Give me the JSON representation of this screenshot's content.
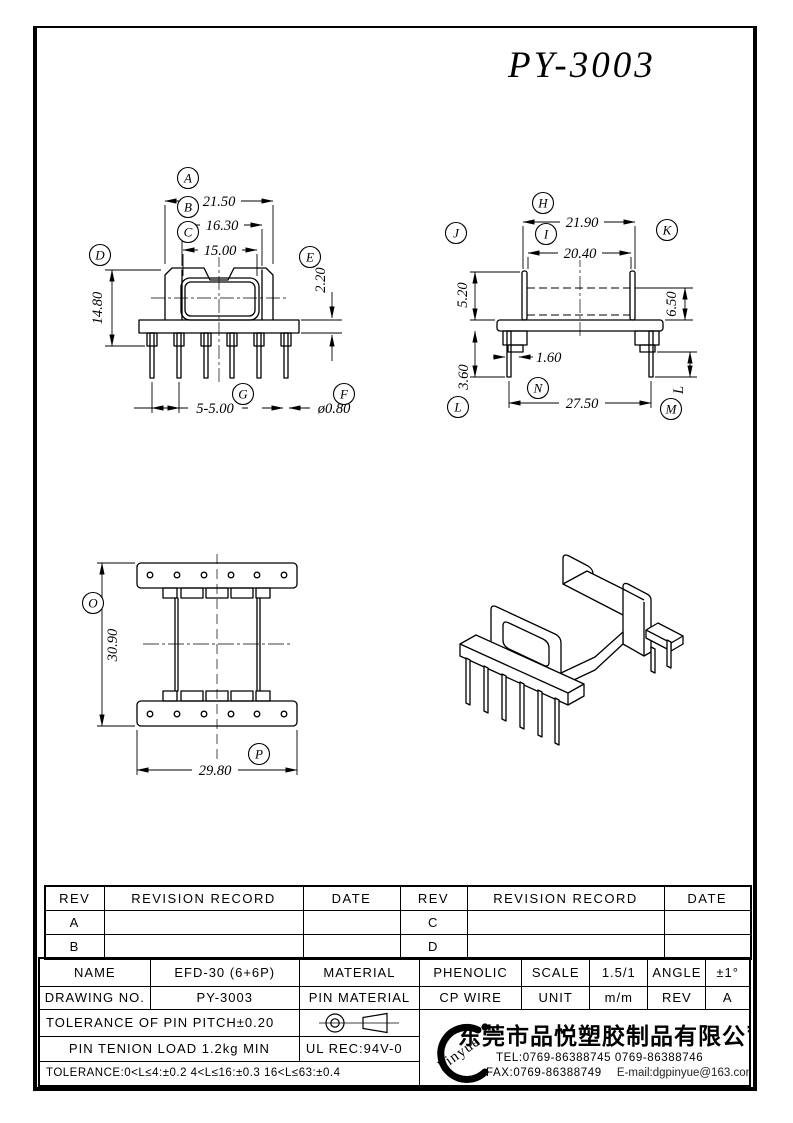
{
  "page": {
    "title": "PY-3003"
  },
  "drawings": {
    "front": {
      "balloons": {
        "A": "A",
        "B": "B",
        "C": "C",
        "D": "D",
        "E": "E",
        "F": "F",
        "G": "G"
      },
      "dims": {
        "A": "21.50",
        "B": "16.30",
        "C": "15.00",
        "D": "14.80",
        "E": "2.20",
        "G": "5-5.00",
        "F": "ø0.80"
      }
    },
    "side": {
      "balloons": {
        "H": "H",
        "I": "I",
        "J": "J",
        "K": "K",
        "L": "L",
        "M": "M",
        "N": "N"
      },
      "dims": {
        "H": "21.90",
        "I": "20.40",
        "J": "5.20",
        "K": "6.50",
        "pin_width": "1.60",
        "L": "3.60",
        "N": "27.50",
        "M": "L"
      }
    },
    "top": {
      "balloons": {
        "O": "O",
        "P": "P"
      },
      "dims": {
        "O": "30.90",
        "P": "29.80"
      }
    }
  },
  "revision_table": {
    "headers": {
      "rev": "REV",
      "record": "REVISION RECORD",
      "date": "DATE"
    },
    "rows": [
      {
        "left_rev": "A",
        "right_rev": "C"
      },
      {
        "left_rev": "B",
        "right_rev": "D"
      }
    ]
  },
  "title_block": {
    "name_label": "NAME",
    "name_value": "EFD-30 (6+6P)",
    "material_label": "MATERIAL",
    "material_value": "PHENOLIC",
    "scale_label": "SCALE",
    "scale_value": "1.5/1",
    "angle_label": "ANGLE",
    "angle_value": "±1°",
    "drawing_no_label": "DRAWING NO.",
    "drawing_no_value": "PY-3003",
    "pin_material_label": "PIN MATERIAL",
    "pin_material_value": "CP WIRE",
    "unit_label": "UNIT",
    "unit_value": "m/m",
    "rev_label": "REV",
    "rev_value": "A",
    "pin_pitch_tolerance": "TOLERANCE OF PIN PITCH±0.20",
    "pin_tension_load": "PIN TENION LOAD  1.2kg MIN",
    "ul_rec": "UL REC:94V-0",
    "general_tolerance": "TOLERANCE:0<L≤4:±0.2  4<L≤16:±0.3  16<L≤63:±0.4"
  },
  "company": {
    "logo_text": "Pinyue",
    "name": "东莞市品悦塑胶制品有限公司",
    "tel": "TEL:0769-86388745    0769-86388746",
    "fax": "FAX:0769-86388749",
    "email": "E-mail:dgpinyue@163.com"
  }
}
